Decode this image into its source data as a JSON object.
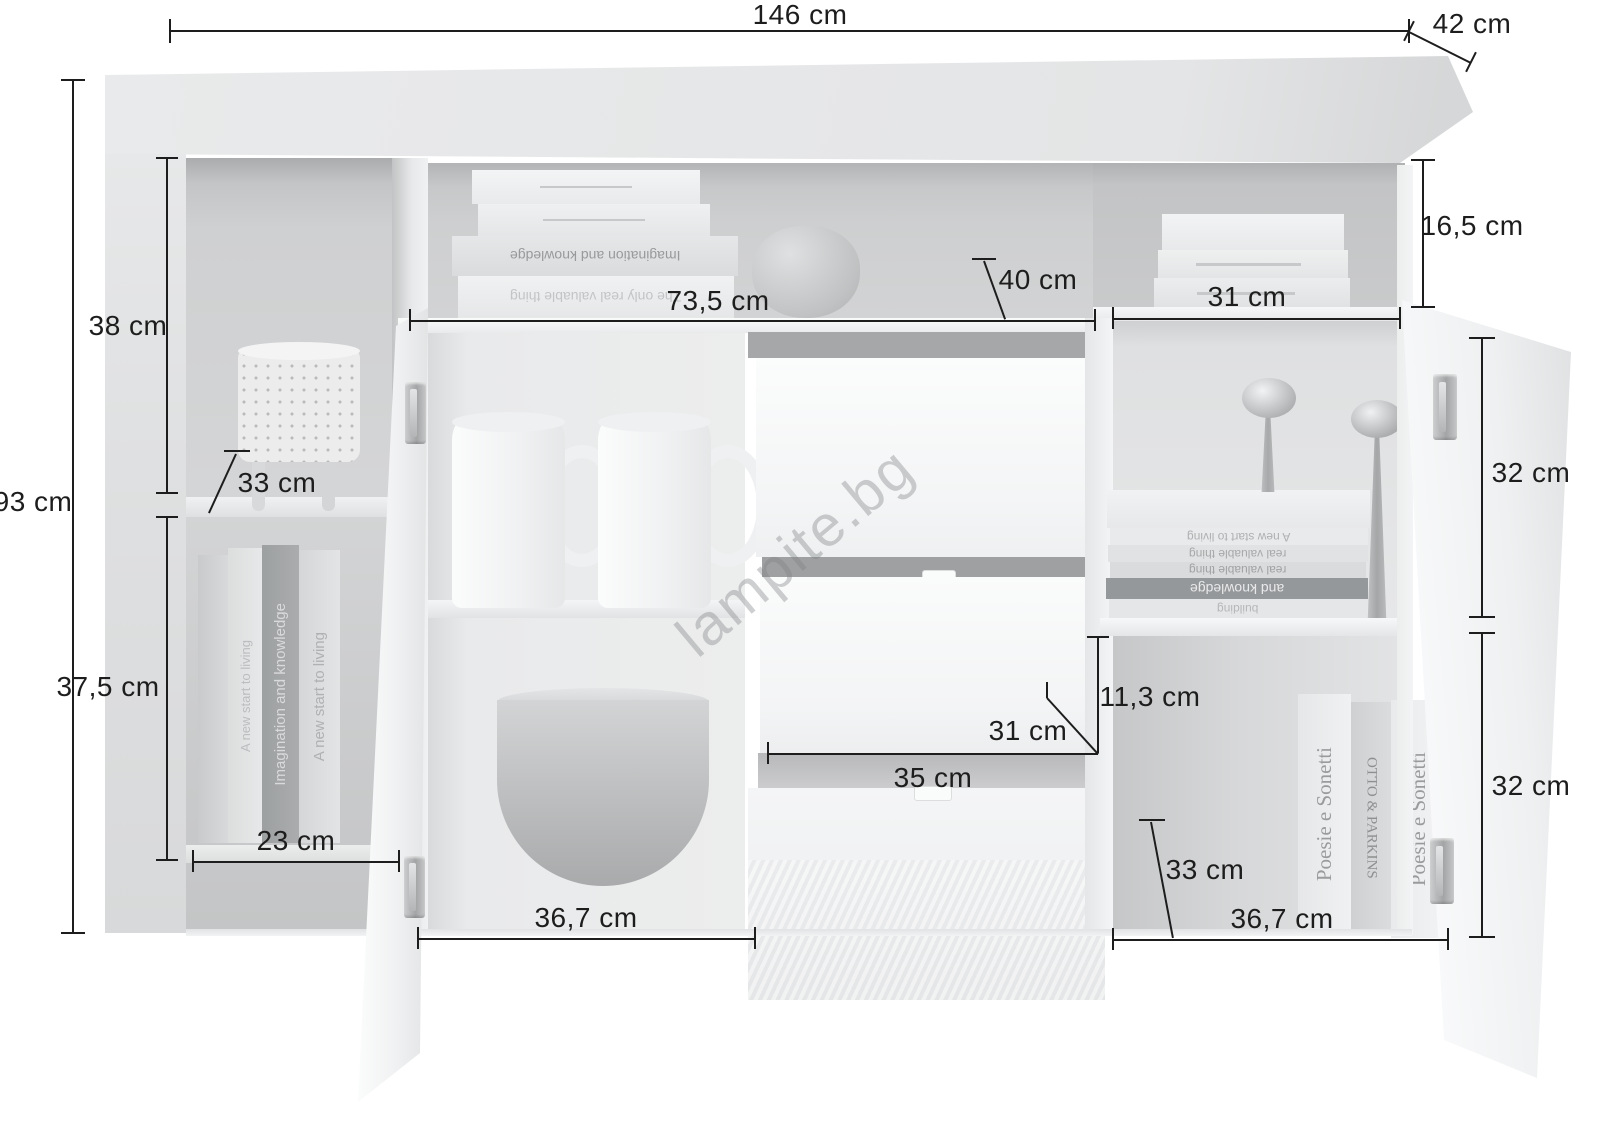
{
  "watermark": "lampite.bg",
  "unit": "cm",
  "dimensions": {
    "total_width": "146 cm",
    "total_depth": "42 cm",
    "total_height": "93 cm",
    "left_upper_height": "38 cm",
    "left_shelf_depth": "33 cm",
    "left_lower_height": "37,5 cm",
    "left_width": "23 cm",
    "top_shelf_width": "73,5 cm",
    "top_shelf_depth": "40 cm",
    "right_niche_width": "31 cm",
    "right_niche_height": "16,5 cm",
    "right_upper_height": "32 cm",
    "right_lower_height": "32 cm",
    "drawer_inner_height": "11,3 cm",
    "drawer_inner_width": "31 cm",
    "drawer_width": "35 cm",
    "right_shelf_depth": "33 cm",
    "right_door_width": "36,7 cm",
    "left_door_width": "36,7 cm"
  },
  "decor": {
    "left_books": [
      "A new start to living",
      "Imagination and knowledge",
      "A new start to living"
    ],
    "top_shelf_books": [
      "Imagination and knowledge",
      "The only real valuable thing"
    ],
    "right_mid_books": [
      "A new start to living",
      "real valuable thing",
      "real valuable thing",
      "and knowledge",
      "building"
    ],
    "right_bottom_books": [
      "Poesie e Sonetti",
      "OTTO & PARKINS",
      "Poesie e Sonetti"
    ]
  }
}
